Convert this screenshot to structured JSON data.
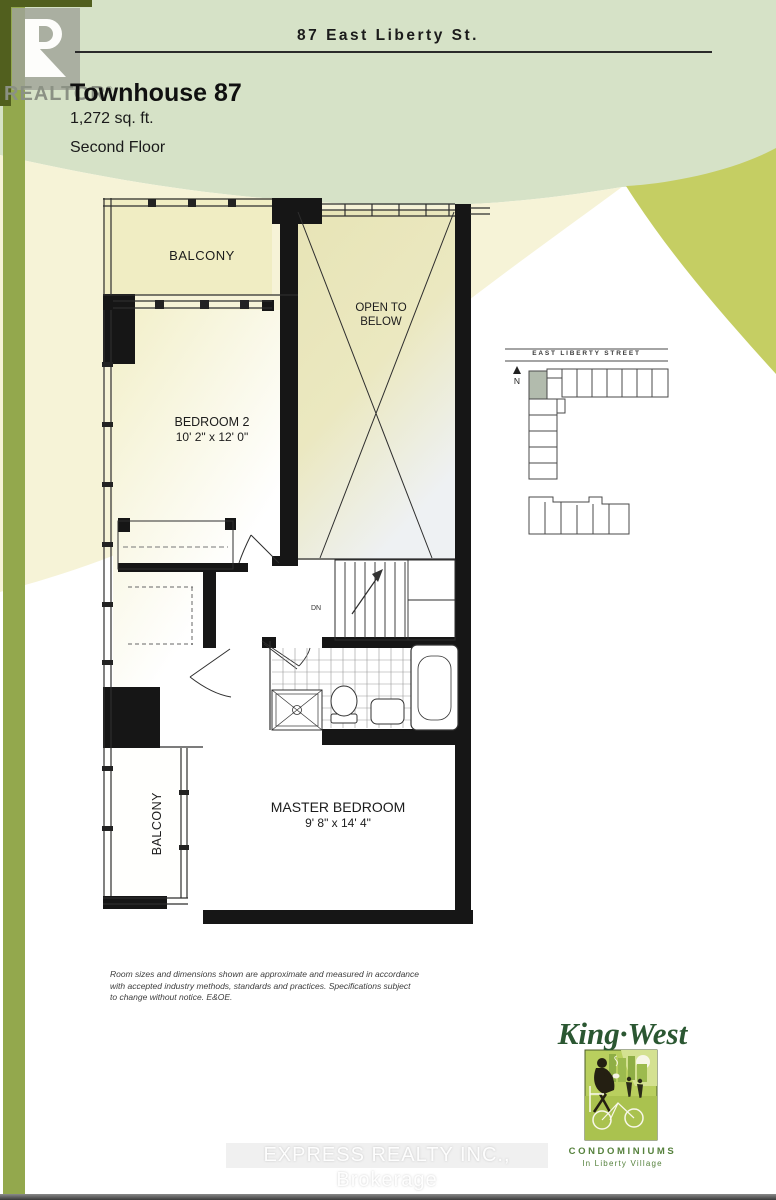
{
  "header": {
    "address": "87 East Liberty St."
  },
  "realtor_logo": {
    "text": "REALTOR",
    "reg": "®"
  },
  "title": {
    "name": "Townhouse 87",
    "area": "1,272 sq. ft.",
    "floor": "Second Floor"
  },
  "floorplan": {
    "balcony_top": "BALCONY",
    "open_below_line1": "OPEN TO",
    "open_below_line2": "BELOW",
    "bedroom2": {
      "name": "BEDROOM 2",
      "dims": "10' 2\" x 12' 0\""
    },
    "master": {
      "name": "MASTER BEDROOM",
      "dims": "9' 8\" x 14' 4\""
    },
    "balcony_left": "BALCONY",
    "stairs_label": "DN"
  },
  "sitemap": {
    "street": "EAST LIBERTY STREET",
    "north": "N"
  },
  "disclaimer": {
    "line1": "Room sizes and dimensions shown are approximate and measured in accordance",
    "line2": "with accepted industry methods, standards and practices. Specifications subject",
    "line3": "to change without notice. E&OE."
  },
  "brand": {
    "name": "King·West",
    "type": "CONDOMINIUMS",
    "location": "In Liberty Village"
  },
  "watermark": "EXPRESS REALTY INC., Brokerage",
  "colors": {
    "sage_band": "#d6e2c7",
    "cream_band": "#f6f3d7",
    "lime_crescent": "#c5ce63",
    "side_strip": "#93a84d",
    "dark_olive": "#515f1e",
    "wall_black": "#161616",
    "brand_green": "#2b5732",
    "highlight_unit": "#b2bbad"
  }
}
